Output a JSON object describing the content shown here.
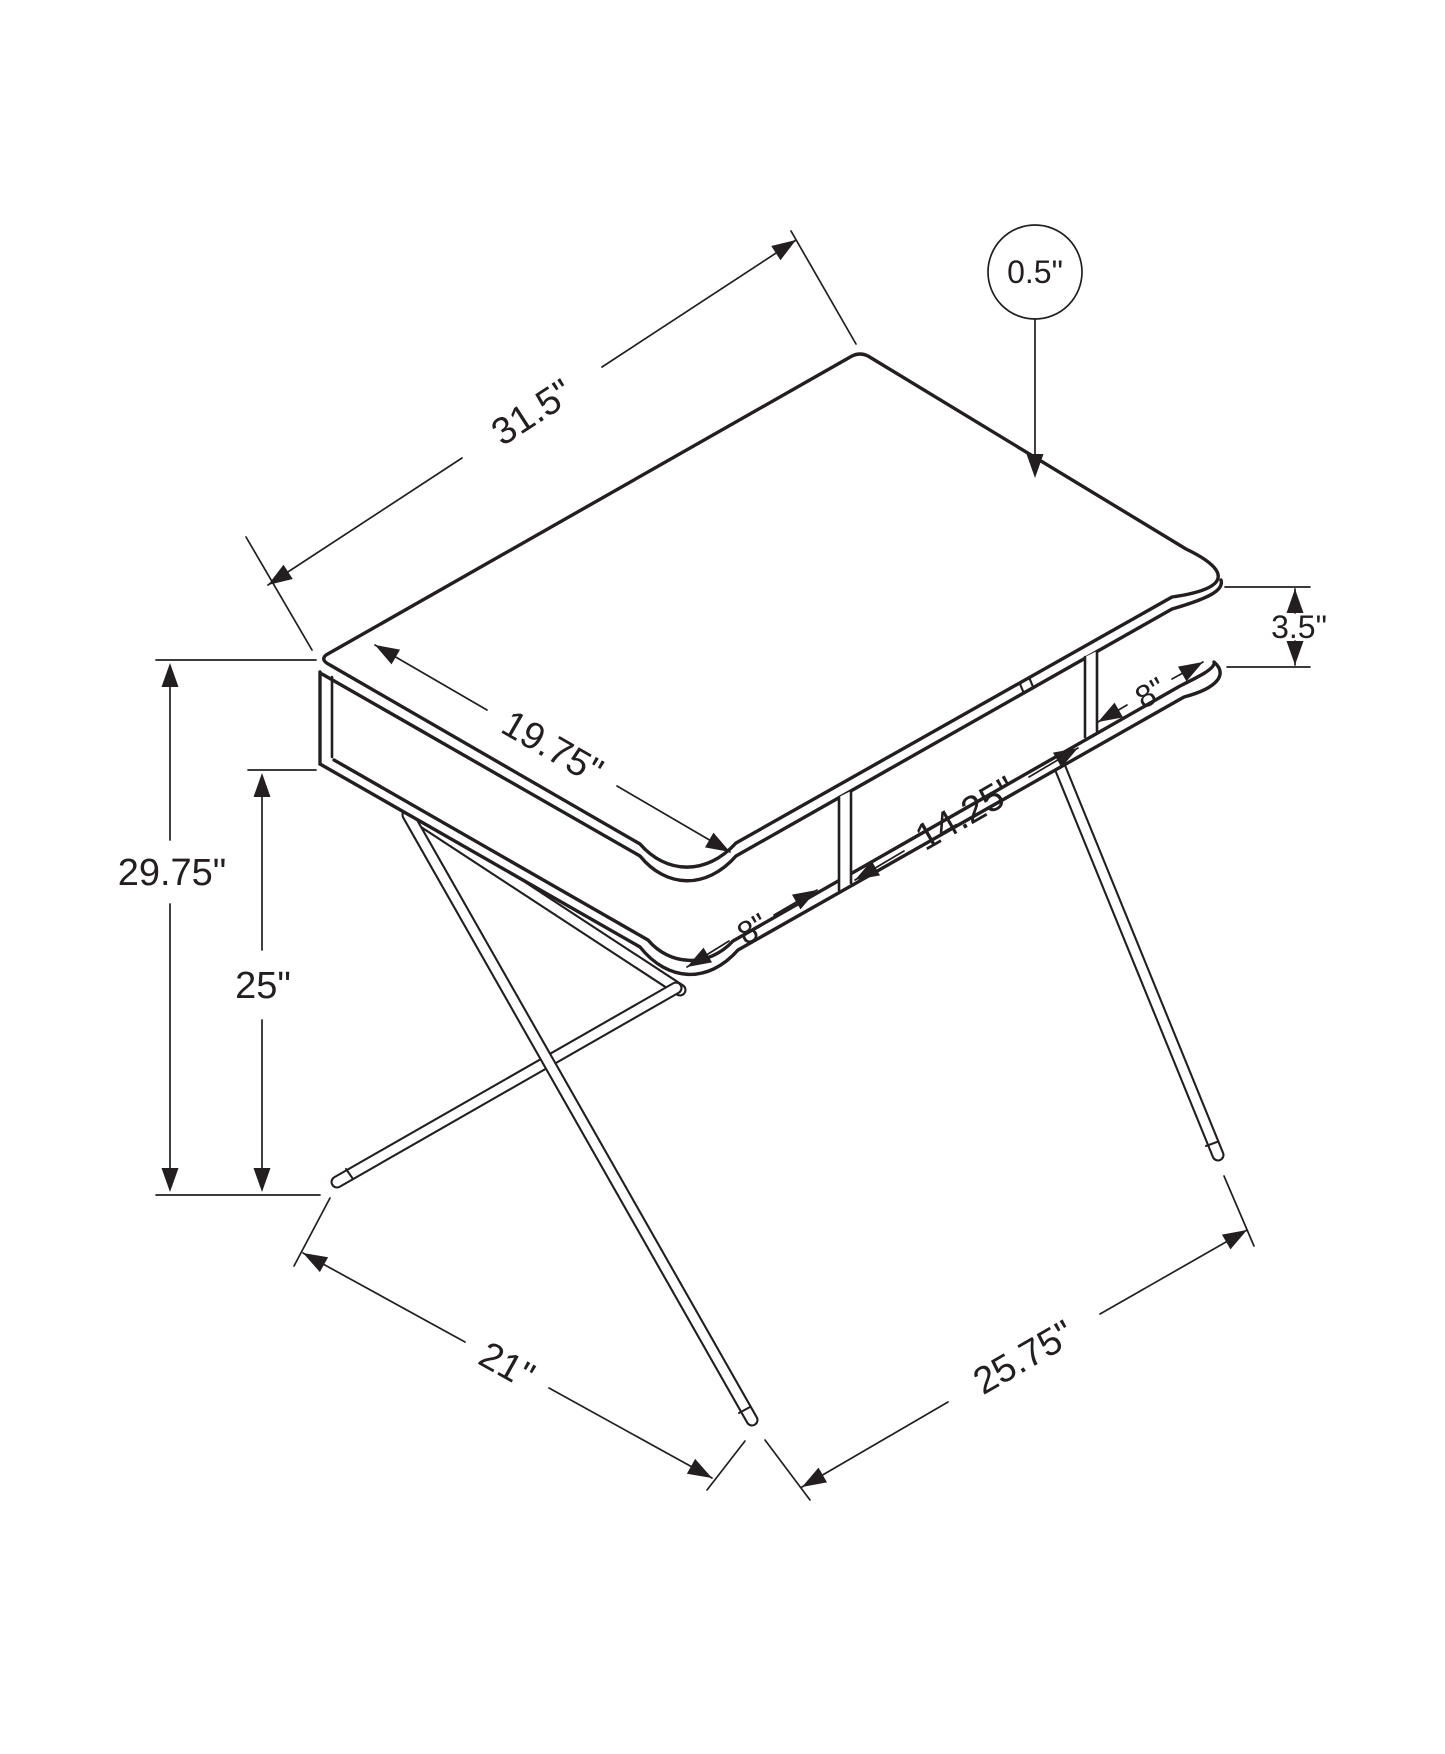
{
  "colors": {
    "line": "#231f20",
    "background": "#ffffff"
  },
  "labels": {
    "top_width": "31.5\"",
    "top_thickness": "0.5\"",
    "top_depth": "19.75\"",
    "hutch_height": "3.5\"",
    "cubby_right": "8\"",
    "cubby_middle": "14.25\"",
    "cubby_left": "8\"",
    "overall_height": "29.75\"",
    "clearance_height": "25\"",
    "base_depth": "21\"",
    "base_width": "25.75\""
  }
}
